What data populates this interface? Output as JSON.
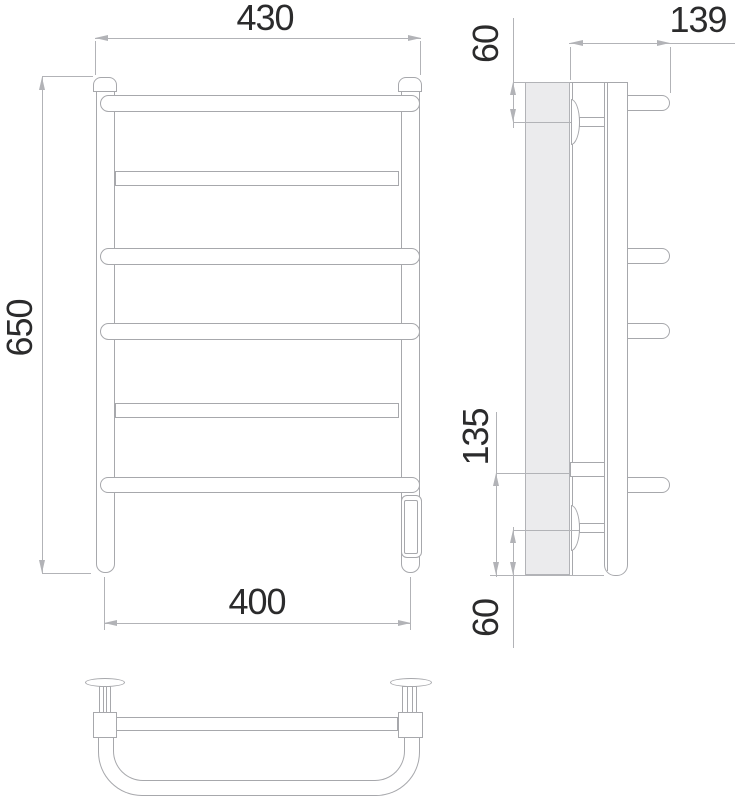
{
  "drawing": {
    "front_view": {
      "width_top": "430",
      "height": "650",
      "width_bottom": "400"
    },
    "side_view": {
      "top_offset": "60",
      "depth": "139",
      "lower_span": "135",
      "bottom_offset": "60"
    },
    "colors": {
      "outline": "#a7a8ac",
      "dim_line": "#b2b3b7",
      "text": "#2b2b2c",
      "wall_fill": "#ebebed",
      "background": "#ffffff"
    }
  }
}
